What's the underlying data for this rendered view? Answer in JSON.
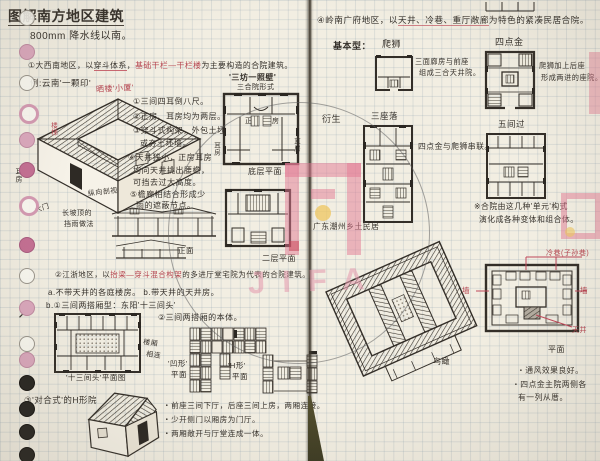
{
  "palette": {
    "ink": "#36312b",
    "red": "#b5444f",
    "paper": "#f2eee2",
    "pink": "#cf7ca0"
  },
  "watermark": {
    "text": "JIFA"
  },
  "margin": {
    "arrow": "↗"
  },
  "left": {
    "title": "图解南方地区建筑",
    "rain": "800mm 降水线以南。",
    "sec1": {
      "pre": "①大西南地区，以",
      "u": "穿斗体系",
      "comma": "，",
      "red": "基础干栏—干栏楼",
      "post": "为主要构造的合院建筑。",
      "example": "例:云南'一颗印'",
      "red_note": "晒楼'小厦'"
    },
    "axo": {
      "ear": "耳房",
      "gate": "大门",
      "stair": "楼梯"
    },
    "notes": [
      "①三间四耳倒八尺。",
      "②正房、耳房均为两层。",
      "③穿斗式构架，外包土坯",
      "或夯土坯墙。",
      "④天井狭小，正房耳房",
      "均向天井挑出腰檐，",
      "可挡去过大高度。",
      "⑤檐廊相结合形成少",
      "雨的遮蔽节点。"
    ],
    "section_label": "纵向剖视",
    "slope1": "长坡顶的",
    "slope2": "挡雨做法",
    "front": "正面",
    "plan1": {
      "t1": "'三坊一照壁'",
      "t2": "三合院形式",
      "zheng1": "正",
      "zheng2": "房",
      "ear_l": "耳房",
      "ear_r": "耳房",
      "caption": "底层平面"
    },
    "plan2_caption": "二层平面",
    "sec2": {
      "pre": "②江浙地区，以",
      "red": "抬梁—穿斗混合构架",
      "post": "的多进厅堂宅院为代表的合院建筑。",
      "ab": "a.不带天井的各庭楼房。  b.带天井的天井房。",
      "b1": "b.①三间两搭厢型：东阳'十三间头'",
      "b2": "②三间两搭厢的本体。"
    },
    "plan3_caption": "'十三间头'平面图",
    "plan3_s1": "楼厢",
    "plan3_s2": "相连",
    "shape1a": "'凹形'",
    "shape1b": "平面",
    "shape2a": "'H形'",
    "shape2b": "平面",
    "sec3": "③'对合式'的H形院",
    "bullets": [
      "・前座三间下厅，后座三间上房，两厢连接。",
      "・少开侧门以厢房为门厅。",
      "・两厢敞开与厅堂连成一体。"
    ]
  },
  "right": {
    "header": {
      "pre": "④岭南广府地区，以",
      "em": "天井、冷巷、重厅敞廊",
      "post": "为特色的紧凑民居合院。"
    },
    "base_label": "基本型：",
    "pashi": "爬狮",
    "sidianjin": "四点金",
    "pashi_note1": "三面廊房与前座",
    "pashi_note2": "组成三合天井院。",
    "sdj_note1": "爬狮加上后座",
    "sdj_note2": "形成两进的座院。",
    "derive": "衍生",
    "sanzuoluo": "三座落",
    "wujianguo": "五间过",
    "serial": "四点金与爬狮串联。",
    "combo1": "※合院由这几种'单元'构式",
    "combo2": "演化成各种变体和组合体。",
    "caption": "广东潮州乡土民居",
    "birdseye": "鸟瞰",
    "red_lane": "冷巷(子孙巷)",
    "wall_l": "墙",
    "wall_r": "墙",
    "tianjing": "天井",
    "plan_caption": "平面",
    "notes": [
      "・通风效果良好。",
      "・四点金主院两侧各",
      "有一列从厝。"
    ]
  },
  "margin_dots": [
    {
      "y": 10,
      "t": "h"
    },
    {
      "y": 44,
      "t": "p"
    },
    {
      "y": 75,
      "t": "h"
    },
    {
      "y": 104,
      "t": "r"
    },
    {
      "y": 132,
      "t": "p"
    },
    {
      "y": 162,
      "t": "P"
    },
    {
      "y": 196,
      "t": "r"
    },
    {
      "y": 237,
      "t": "P"
    },
    {
      "y": 268,
      "t": "h"
    },
    {
      "y": 300,
      "t": "p"
    },
    {
      "y": 336,
      "t": "h"
    },
    {
      "y": 352,
      "t": "p"
    },
    {
      "y": 375,
      "t": "b"
    },
    {
      "y": 401,
      "t": "b"
    },
    {
      "y": 424,
      "t": "b"
    },
    {
      "y": 447,
      "t": "b"
    }
  ]
}
